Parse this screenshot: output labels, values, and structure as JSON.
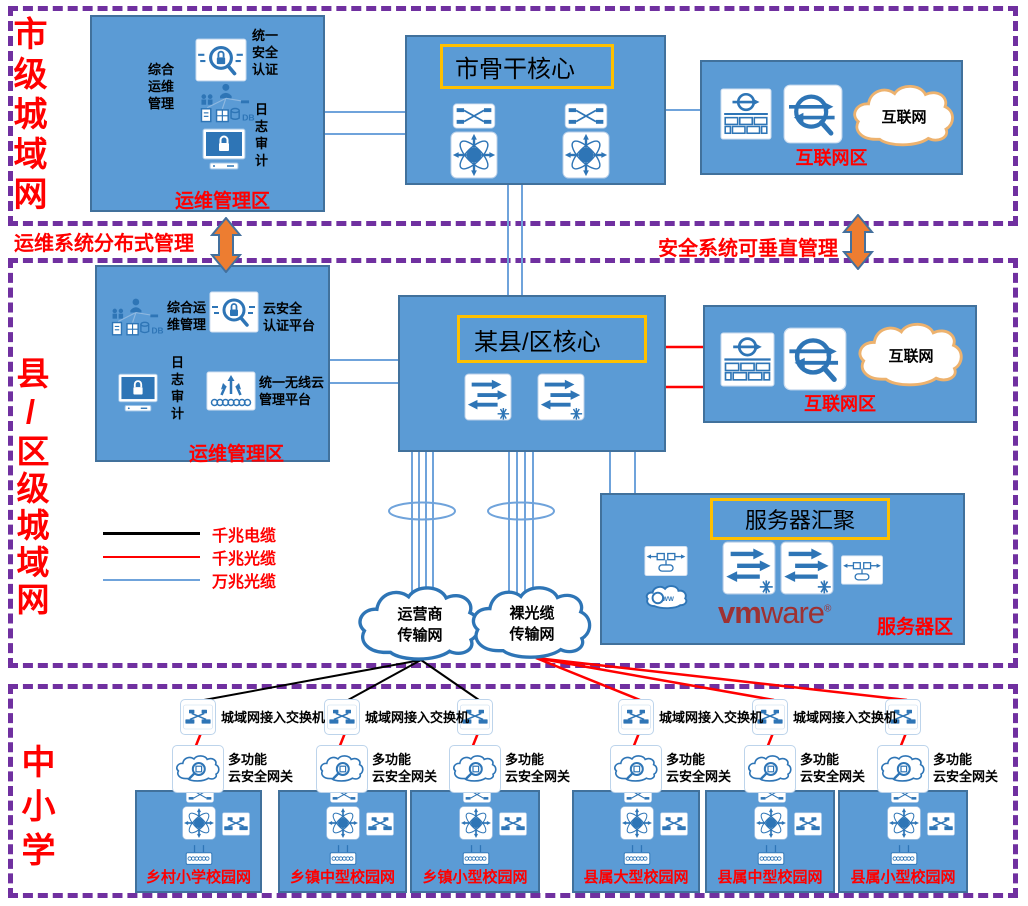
{
  "sections": {
    "city": {
      "label": "市级城域网"
    },
    "county": {
      "label": "县/区级城域网"
    },
    "schools": {
      "label": "中小学"
    }
  },
  "banners": {
    "ops_distributed": "运维系统分布式管理",
    "security_vertical": "安全系统可垂直管理"
  },
  "city": {
    "ops": {
      "auth": "统一\n安全\n认证",
      "mgmt": "综合\n运维\n管理",
      "audit": "日\n志\n审\n计",
      "zone": "运维管理区"
    },
    "core": {
      "title": "市骨干核心"
    },
    "internet": {
      "cloud": "互联网",
      "zone": "互联网区"
    }
  },
  "county": {
    "ops": {
      "mgmt": "综合运\n维管理",
      "cloud_auth": "云安全\n认证平台",
      "audit": "日\n志\n审\n计",
      "wireless": "统一无线云\n管理平台",
      "zone": "运维管理区"
    },
    "core": {
      "title": "某县/区核心"
    },
    "internet": {
      "cloud": "互联网",
      "zone": "互联网区"
    },
    "server": {
      "title": "服务器汇聚",
      "brand_bold": "vm",
      "brand_light": "ware",
      "brand_reg": "®",
      "zone": "服务器区"
    },
    "legend": {
      "items": [
        {
          "label": "千兆电缆",
          "color": "#000000"
        },
        {
          "label": "千兆光缆",
          "color": "#FF0000"
        },
        {
          "label": "万兆光缆",
          "color": "#6FA3DB"
        }
      ]
    },
    "clouds": {
      "carrier": "运营商\n传输网",
      "fiber": "裸光缆\n传输网"
    }
  },
  "schools": {
    "access_switch": "城域网接入交换机",
    "gateway": "多功能\n云安全网关",
    "campuses": [
      "乡村小学校园网",
      "乡镇中型校园网",
      "乡镇小型校园网",
      "县属大型校园网",
      "县属中型校园网",
      "县属小型校园网"
    ]
  },
  "colors": {
    "box_blue": "#5B9BD5",
    "border_blue": "#41719C",
    "purple": "#7030A0",
    "red": "#FF0000",
    "orange_arrow": "#ED7D31",
    "title_yellow": "#FFC000",
    "icon_blue": "#2E75B6",
    "line_blue": "#6FA3DB",
    "vmware": "#9E3132"
  }
}
